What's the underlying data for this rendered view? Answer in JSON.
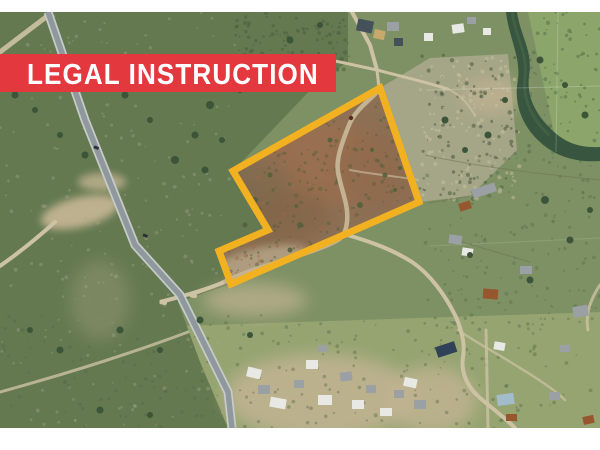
{
  "banner": {
    "label": "LEGAL INSTRUCTION",
    "bg_color": "#e4383f",
    "text_color": "#ffffff"
  },
  "parcel": {
    "outline_color": "#f2b120",
    "stroke_width": "7",
    "points": "380,88 419,202 231,284 219,251 268,230 233,171",
    "fill_color": "#8d7156"
  },
  "map": {
    "frame_color": "#ffffff",
    "terrain_base": "#7e9164",
    "scrub_dark": "#647950",
    "grass_light": "#95a471",
    "grass_topright": "#8ba56a",
    "rocky_pale": "#aaa78b",
    "dirt_road": "#cdc2a4",
    "dirt_patch": "#c2b493",
    "highway": "#8f989d",
    "highway_casing": "#c6cac9",
    "river": "#34523d",
    "vehicle_dark": "#2e3337",
    "building_white": "#e8e8e4",
    "building_gray": "#9aa0a3",
    "building_dark": "#44505a",
    "building_rust": "#96562e",
    "building_navy": "#2f4257",
    "building_lightblue": "#a3bccb",
    "building_tan": "#c8a96c"
  }
}
